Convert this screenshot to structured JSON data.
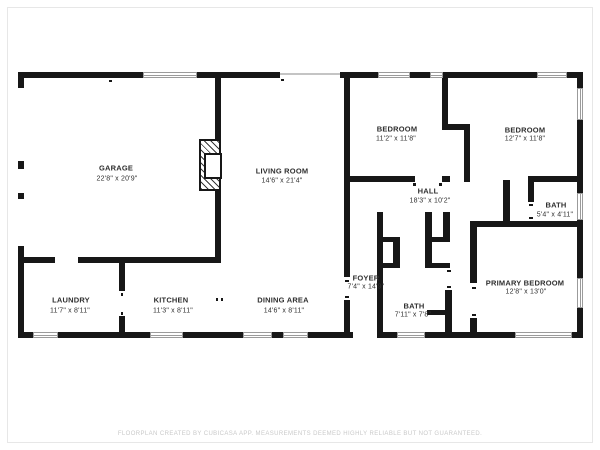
{
  "watermark": "FLOORPLAN CREATED BY CUBICASA APP. MEASUREMENTS DEEMED HIGHLY RELIABLE BUT NOT GUARANTEED.",
  "colors": {
    "wall": "#171717",
    "window_border": "#9b9b9b",
    "label_text": "#2f2f2f",
    "watermark_text": "#c9c9c9"
  },
  "rooms": [
    {
      "name": "GARAGE",
      "dims": "22'8\" x 20'9\""
    },
    {
      "name": "LIVING ROOM",
      "dims": "14'6\" x 21'4\""
    },
    {
      "name": "BEDROOM",
      "dims": "11'2\" x 11'8\""
    },
    {
      "name": "BEDROOM",
      "dims": "12'7\" x 11'8\""
    },
    {
      "name": "HALL",
      "dims": "18'3\" x 10'2\""
    },
    {
      "name": "BATH",
      "dims": "5'4\" x 4'11\""
    },
    {
      "name": "FOYER",
      "dims": "7'4\" x 14'9\""
    },
    {
      "name": "BATH",
      "dims": "7'11\" x 7'8\""
    },
    {
      "name": "PRIMARY BEDROOM",
      "dims": "12'8\" x 13'0\""
    },
    {
      "name": "LAUNDRY",
      "dims": "11'7\" x 8'11\""
    },
    {
      "name": "KITCHEN",
      "dims": "11'3\" x 8'11\""
    },
    {
      "name": "DINING AREA",
      "dims": "14'6\" x 8'11\""
    }
  ]
}
